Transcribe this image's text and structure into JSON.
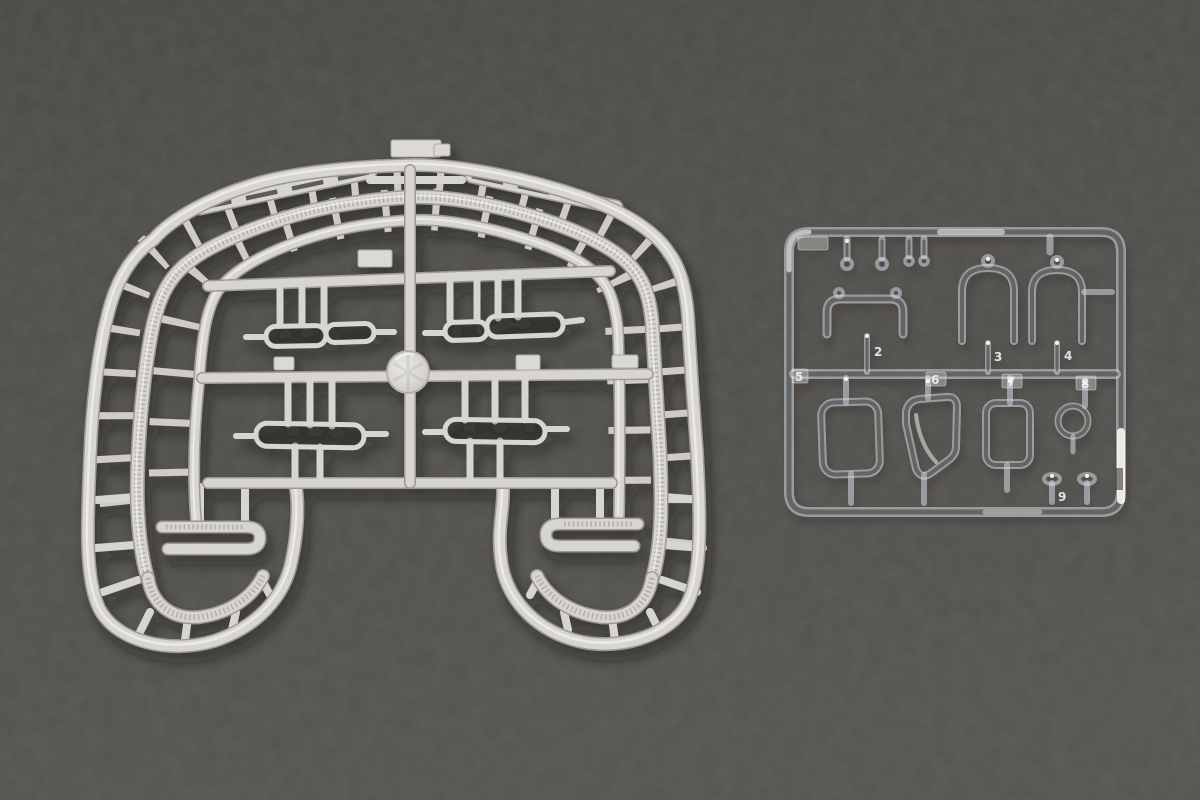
{
  "colors": {
    "background": "#4b4946",
    "gray_plastic": "#d7d5cf",
    "gray_plastic_shadow": "#9e9a92",
    "gray_plastic_highlight": "#f1f0ec",
    "clear_plastic_highlight": "#ffffff"
  },
  "gray_sprue": {
    "material": "light-gray styrene"
  },
  "clear_sprue": {
    "material": "clear transparent styrene",
    "part_labels": {
      "p2": "2",
      "p3": "3",
      "p4": "4",
      "p5": "5",
      "p6": "6",
      "p7": "7",
      "p8": "8",
      "p9": "9"
    }
  }
}
